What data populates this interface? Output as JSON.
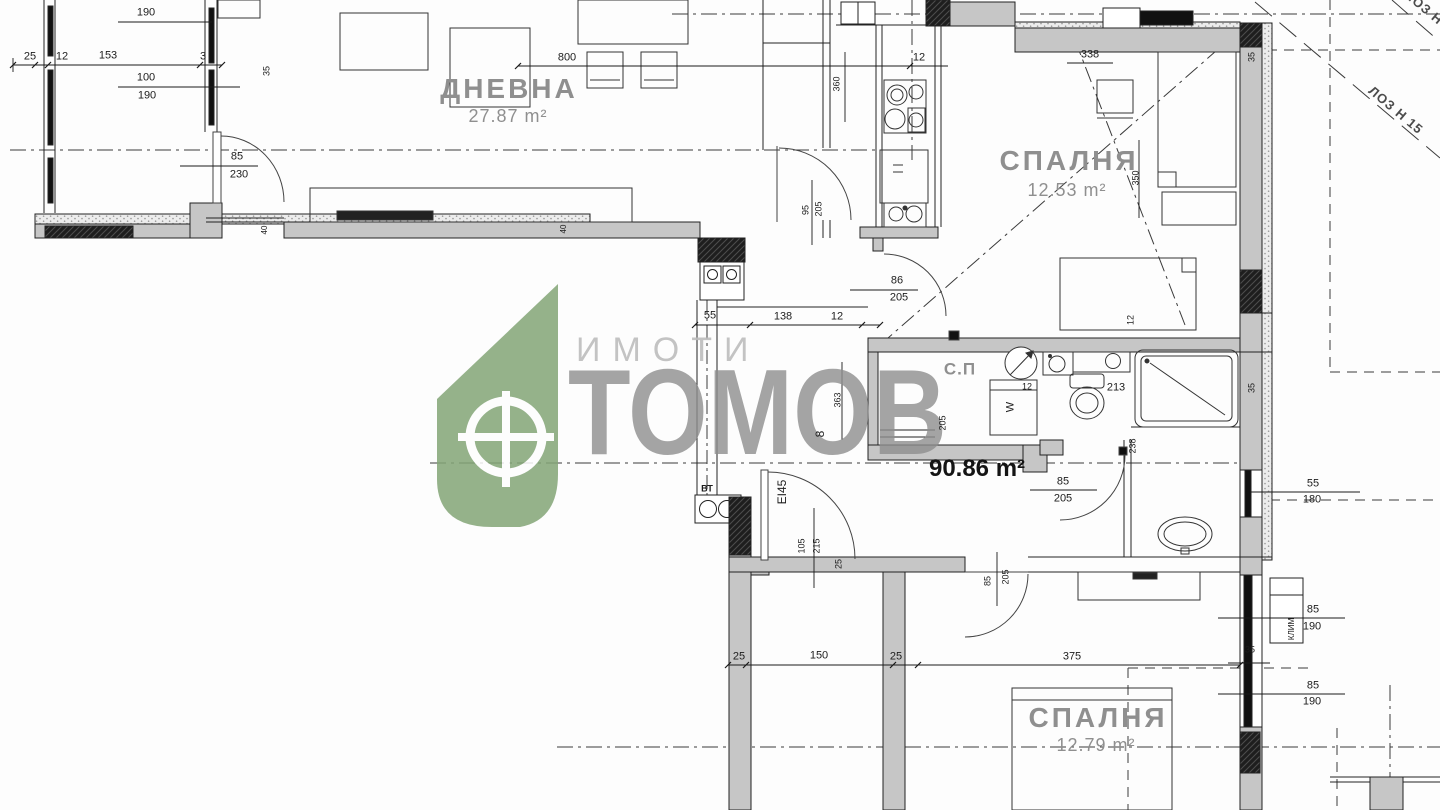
{
  "watermark": {
    "brand_top": "ИМОТИ",
    "brand_name": "ТОМОВ",
    "green": "#84a577",
    "text_gray": "#8e8e8e"
  },
  "total_area": "90.86 m²",
  "rooms": {
    "living": {
      "name": "ДНЕВНА",
      "area": "27.87 m²"
    },
    "bedroom_top": {
      "name": "СПАЛНЯ",
      "area": "12.53 m²"
    },
    "bedroom_bottom": {
      "name": "СПАЛНЯ",
      "area": "12.79 m²"
    },
    "closet": {
      "name": "С.П"
    }
  },
  "site": {
    "plot_label_main": "ЛОЗ Н 15",
    "plot_label_corner": "ЛОЗ Н 15"
  },
  "labels": {
    "vt": "ВТ",
    "door_rating": "EI45",
    "washer": "W",
    "ac_unit": "КЛИМ",
    "shaft": "8"
  },
  "dims": {
    "d01": "190",
    "d02": "25",
    "d03": "12",
    "d04": "153",
    "d05": "3",
    "d06": "100",
    "d07": "190",
    "d08": "35",
    "d09": "85",
    "d10": "230",
    "d11": "800",
    "d12": "360",
    "d13": "12",
    "d14": "95",
    "d15": "205",
    "d16": "40",
    "d17": "40",
    "d18": "338",
    "d19": "350",
    "d20": "12",
    "d21": "35",
    "d22": "86",
    "d23": "205",
    "d24": "55",
    "d25": "138",
    "d26": "12",
    "d27": "363",
    "d28": "205",
    "d29": "12",
    "d30": "213",
    "d31": "238",
    "d32": "35",
    "d33": "55",
    "d34": "180",
    "d35": "85",
    "d36": "205",
    "d37": "105",
    "d38": "215",
    "d39": "25",
    "d40": "25",
    "d41": "150",
    "d42": "25",
    "d43": "375",
    "d44": "85",
    "d45": "205",
    "d46": "85",
    "d47": "190",
    "d48": "85",
    "d49": "190",
    "d50": "35"
  }
}
